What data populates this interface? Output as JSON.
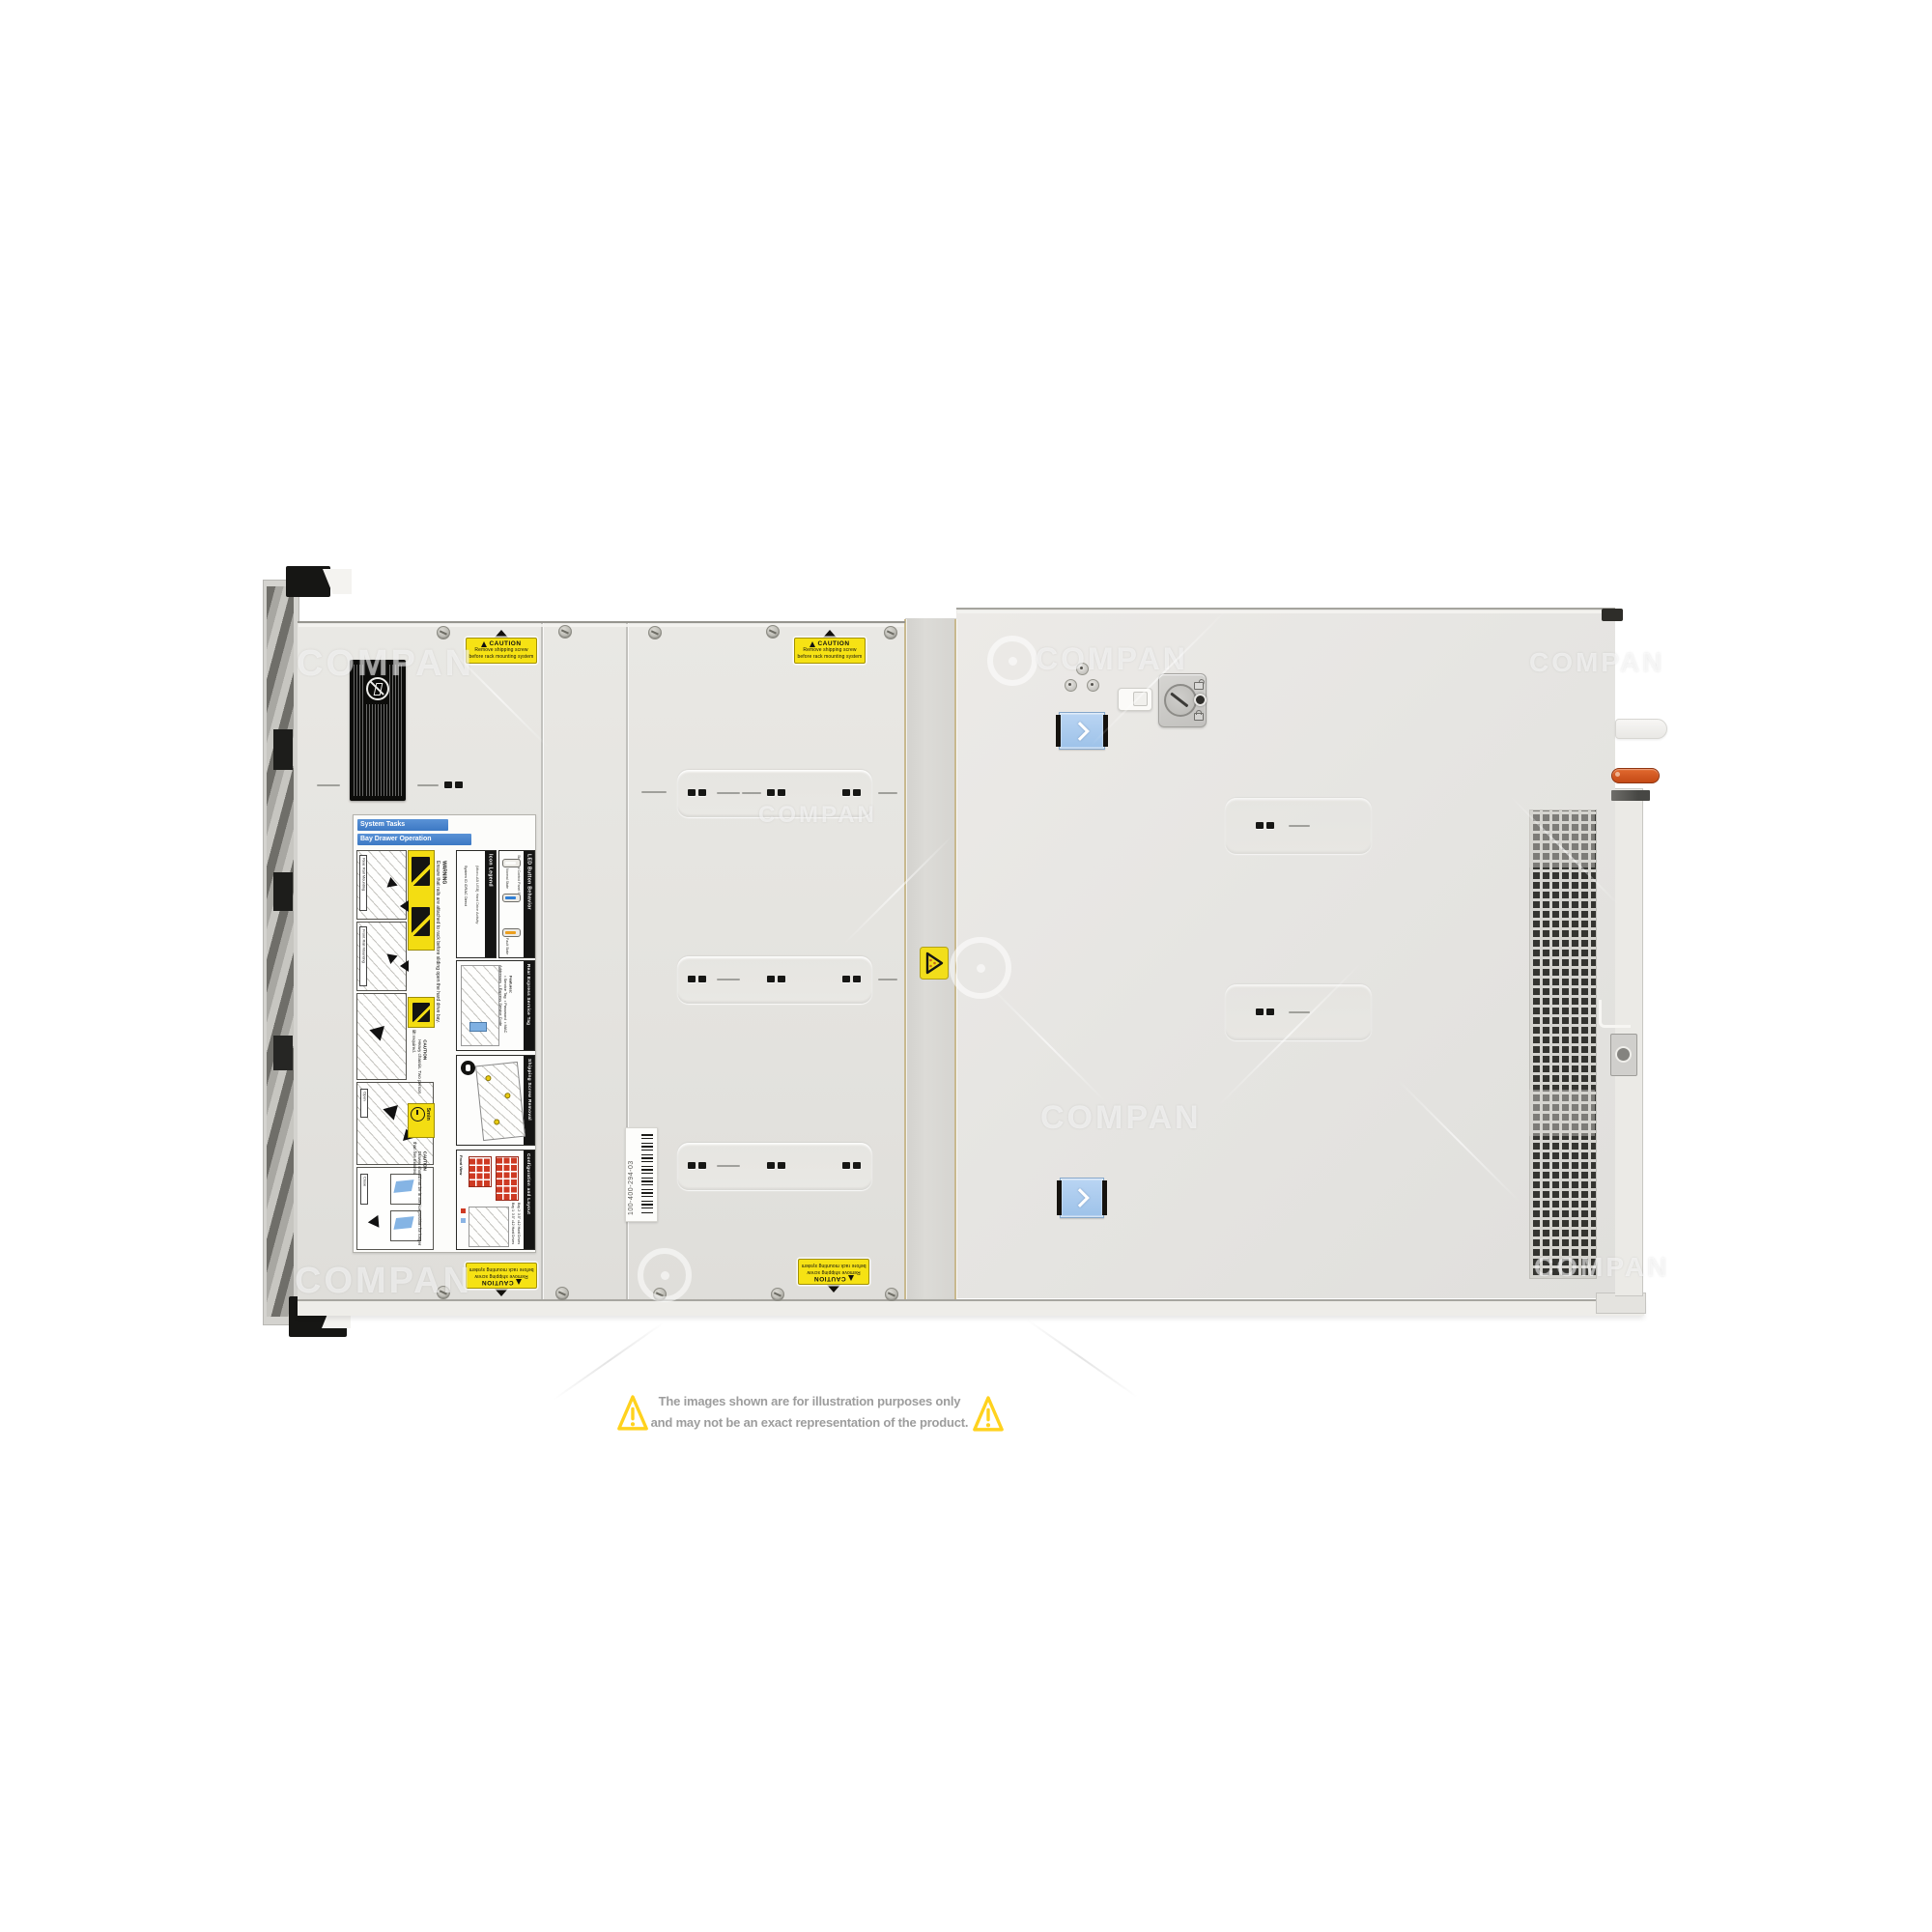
{
  "page": {
    "watermark": {
      "text": "COMPAN"
    },
    "disclaimer": {
      "line1": "The images shown are for illustration purposes only",
      "line2": "and may not be an exact representation of the product.",
      "text_color": "#9d9d9d",
      "triangle_color": "#FFD21E"
    }
  },
  "server": {
    "shipping_caution": {
      "title": "CAUTION",
      "line1": "Remove shipping screw",
      "line2": "before rack mounting system"
    },
    "part_label": {
      "part_number": "100-400-294-03"
    },
    "service_label": {
      "system_tasks": "System Tasks",
      "bay_drawer_operation": "Bay Drawer Operation",
      "rear_rail_mounting": "Rear Rail Mounting",
      "front_rail_mounting": "Front Rail Mounting",
      "open_tag": "Open",
      "close_tag": "Close",
      "warning_title": "WARNING",
      "warning_text": "Ensure that rails are attached to rack before sliding open the hard drive bay.",
      "icon_legend_title": "Icon Legend",
      "icon_items": [
        "System ID",
        "iDRAC Direct",
        "(Micro-AB USB)",
        "Hard Drive Activity"
      ],
      "led_title": "LED Button Behavior",
      "led_subtitle": "Standard Control Panel Status",
      "led_normal": "Normal State",
      "led_fault": "Fault State",
      "service_tag_title": "Rear Express Service Tag",
      "features_heading": "Features:",
      "features_list": "• Service Tag  • Password  • MAC Addresses  • Express Service Code",
      "pull_tag": "Pull to see Tag",
      "caution_heavy_title": "CAUTION",
      "caution_heavy_text": "Heavy chassis. Two person lift required.",
      "shipping_screw_title": "Shipping Screw Removal",
      "five_min": "5min",
      "caution_drawer_title": "CAUTION",
      "caution_drawer_text": "Drawer should not be in service position for longer than five minutes.",
      "config_title": "Configuration and Layout",
      "front_view": "Front View",
      "bay1": "Bay 1: 3.5\" x12 Hard Drives",
      "bay2": "Bay 2: 3.5\" x12 Hard Drives"
    }
  }
}
